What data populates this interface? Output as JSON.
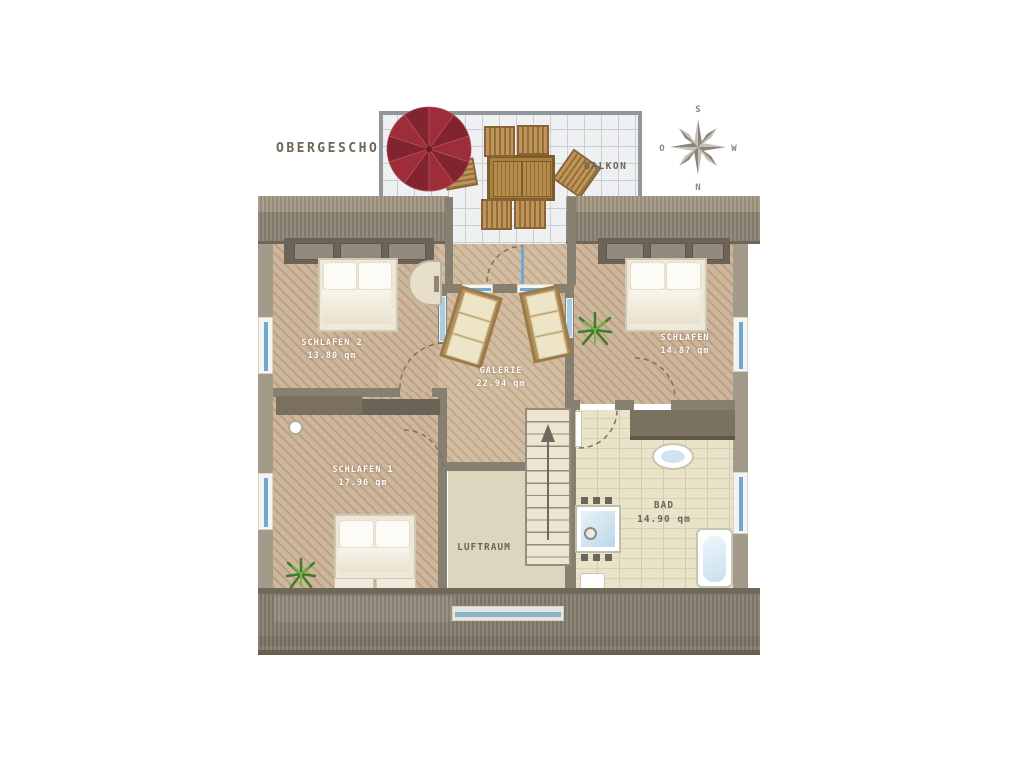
{
  "title": "OBERGESCHOSS",
  "compass": {
    "top": "S",
    "right": "W",
    "bottom": "N",
    "left": "O"
  },
  "rooms": {
    "balkon": {
      "label": "BALKON"
    },
    "schlafen2": {
      "label": "SCHLAFEN 2",
      "area": "13.80 qm"
    },
    "schlafen3": {
      "label": "SCHLAFEN",
      "area": "14.87 qm"
    },
    "galerie": {
      "label": "GALERIE",
      "area": "22.94 qm"
    },
    "schlafen1": {
      "label": "SCHLAFEN 1",
      "area": "17.96 qm"
    },
    "bad": {
      "label": "BAD",
      "area": "14.90 qm"
    },
    "luftraum": {
      "label": "LUFTRAUM"
    }
  },
  "colors": {
    "umbrella_red": "#9d2d38",
    "window_glass": "#6fa8d2",
    "wood_floor": "#cdb69c",
    "roof_gray": "#8b8476",
    "bath_tile": "#e9e4c9"
  }
}
